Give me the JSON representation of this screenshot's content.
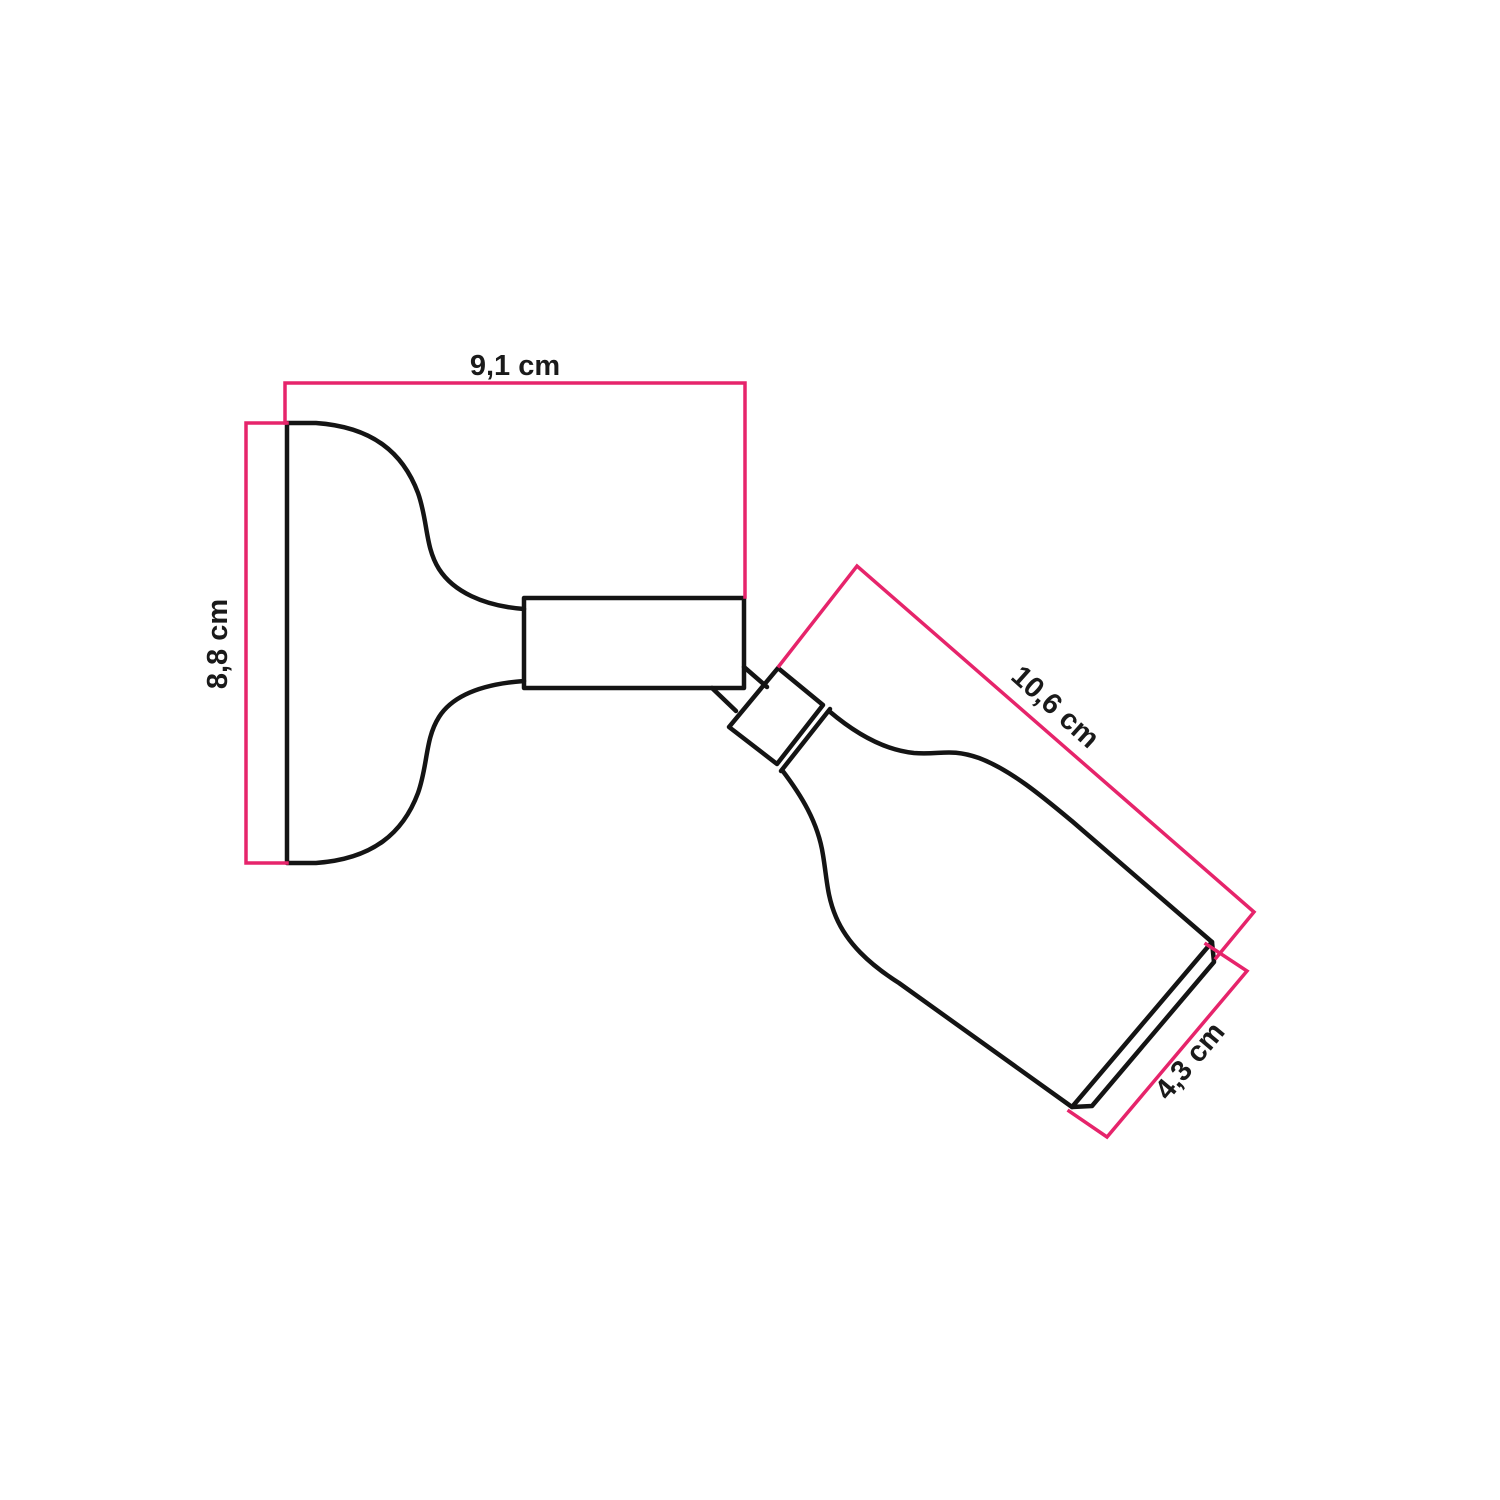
{
  "colors": {
    "background": "#ffffff",
    "outline": "#141414",
    "dimension": "#e6246b",
    "label": "#1a1a1a"
  },
  "diagram": {
    "dimensions": {
      "width": {
        "label": "9,1 cm"
      },
      "height": {
        "label": "8,8 cm"
      },
      "length": {
        "label": "10,6 cm"
      },
      "diameter": {
        "label": "4,3 cm"
      }
    }
  }
}
